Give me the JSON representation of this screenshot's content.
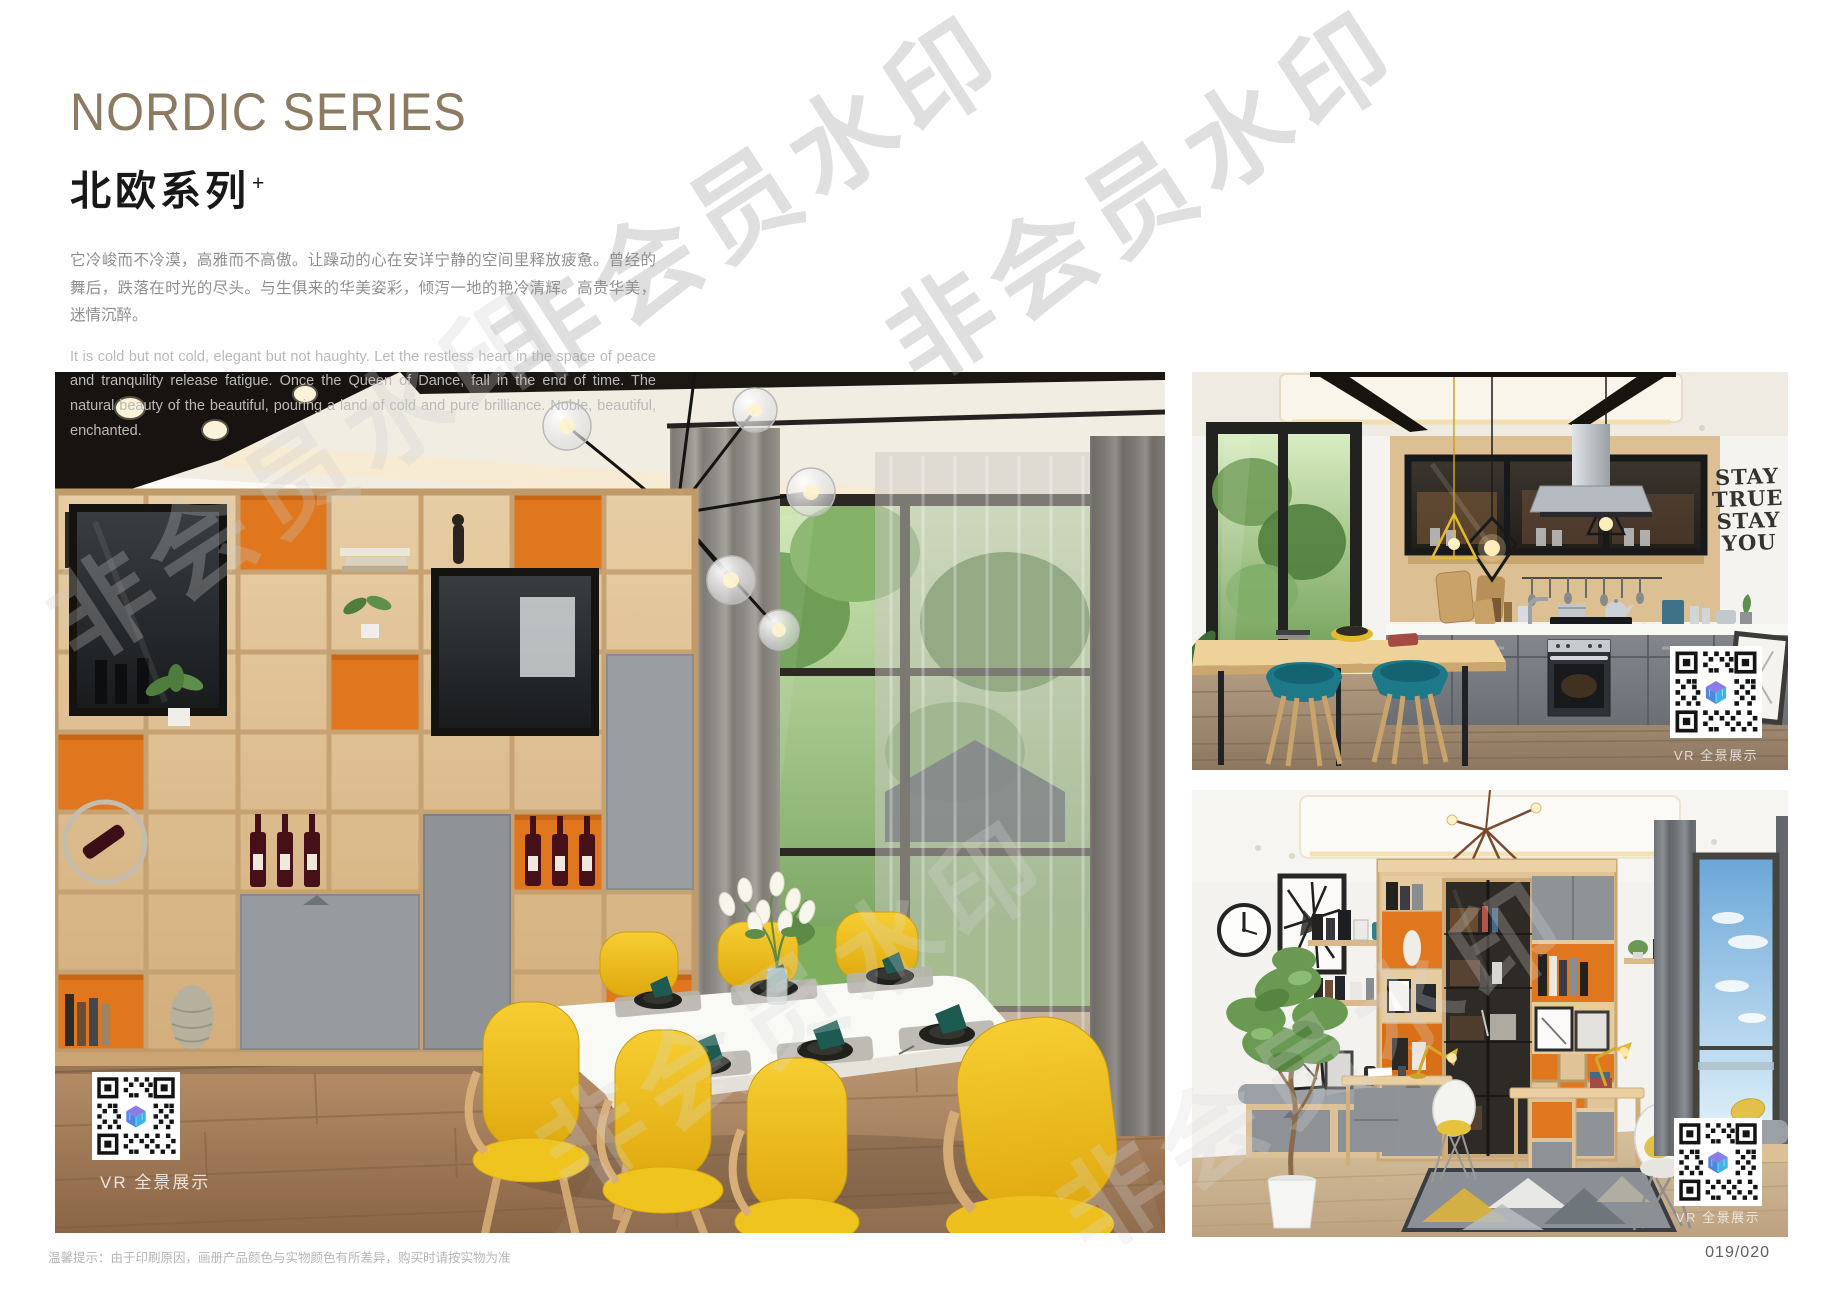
{
  "page": {
    "watermark_text": "非会员水印",
    "footer_note": "温馨提示：由于印刷原因，画册产品颜色与实物颜色有所差异，购买时请按实物为准",
    "page_number": "019/020"
  },
  "header": {
    "title_en": "NORDIC SERIES",
    "title_cn": "北欧系列",
    "title_superscript": "+",
    "accent_color": "#8c7a61",
    "desc_cn": "它冷峻而不冷漠，高雅而不高傲。让躁动的心在安详宁静的空间里释放疲惫。曾经的舞后，跌落在时光的尽头。与生俱来的华美姿彩，倾泻一地的艳冷清辉。高贵华美，迷情沉醉。",
    "desc_en": "It is cold but not cold, elegant but not haughty. Let the restless heart in the space of peace and tranquility release fatigue. Once the Queen of Dance, fall in the end of time. The natural beauty of the beautiful, pouring a land of cold and pure brilliance. Noble, beautiful, enchanted."
  },
  "photos": {
    "dining_room": {
      "vr_label": "VR 全景展示"
    },
    "kitchen": {
      "vr_label": "VR 全景展示",
      "wall_art_lines": [
        "STAY",
        "TRUE",
        "STAY",
        "YOU"
      ]
    },
    "study": {
      "vr_label": "VR 全景展示"
    }
  }
}
